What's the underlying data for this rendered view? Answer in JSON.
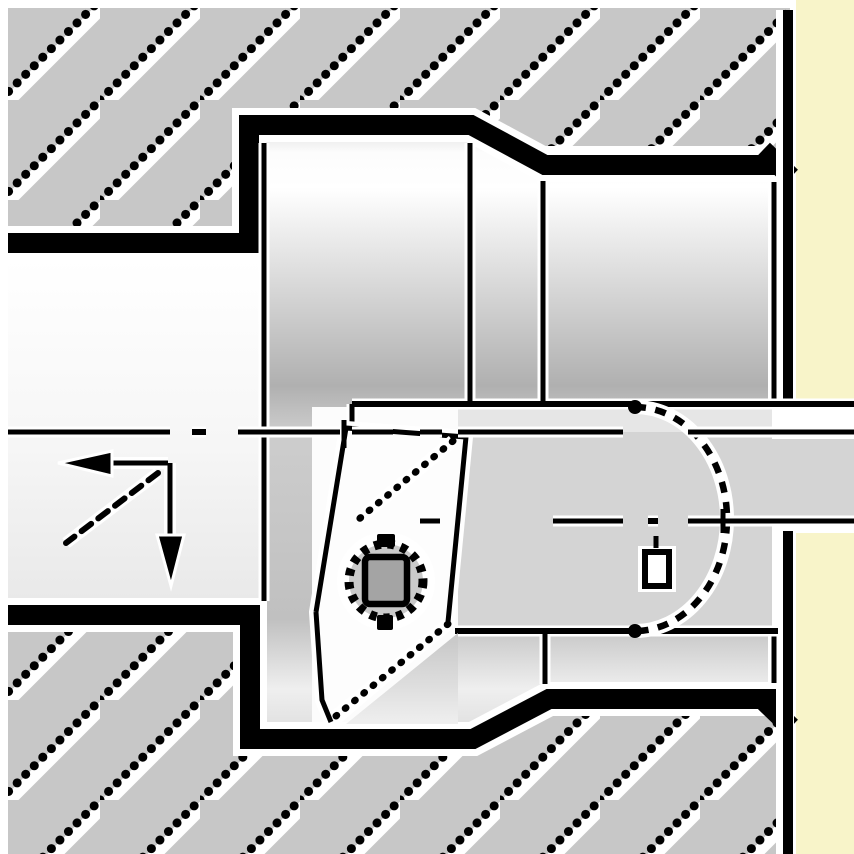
{
  "drawing": {
    "kind": "technical-illustration",
    "subject": "internal-boring-operation-cross-section",
    "components": {
      "workpiece_upper": "hatched-cross-section",
      "workpiece_lower": "hatched-cross-section",
      "tool": "boring-bar-with-head",
      "insert": "35deg-diamond-insert",
      "screw": "torx-clamp-screw",
      "hidden_arc": "dashed-hidden-contour",
      "centerline_main": "dash-dot-axis",
      "centerline_secondary": "dash-dot-axis",
      "feed_arrows": "left-and-down-solid-arrows"
    }
  },
  "colors": {
    "background": "#FFFFFF",
    "page_margin": "#F8F4C9",
    "hatch_gray": "#C7C7C7",
    "line_black": "#000000",
    "halo_white": "#FFFFFF",
    "flat_gray": "#D4D4D4",
    "flat_light": "#E6E6E6",
    "pocket_white": "#FCFCFC",
    "insert_white": "#FDFDFD",
    "seat_gray": "#C2C2C2",
    "screw_ring_gray": "#CACACA",
    "screw_socket_gray": "#A4A4A4",
    "frame_line": "#CBCBCB"
  }
}
